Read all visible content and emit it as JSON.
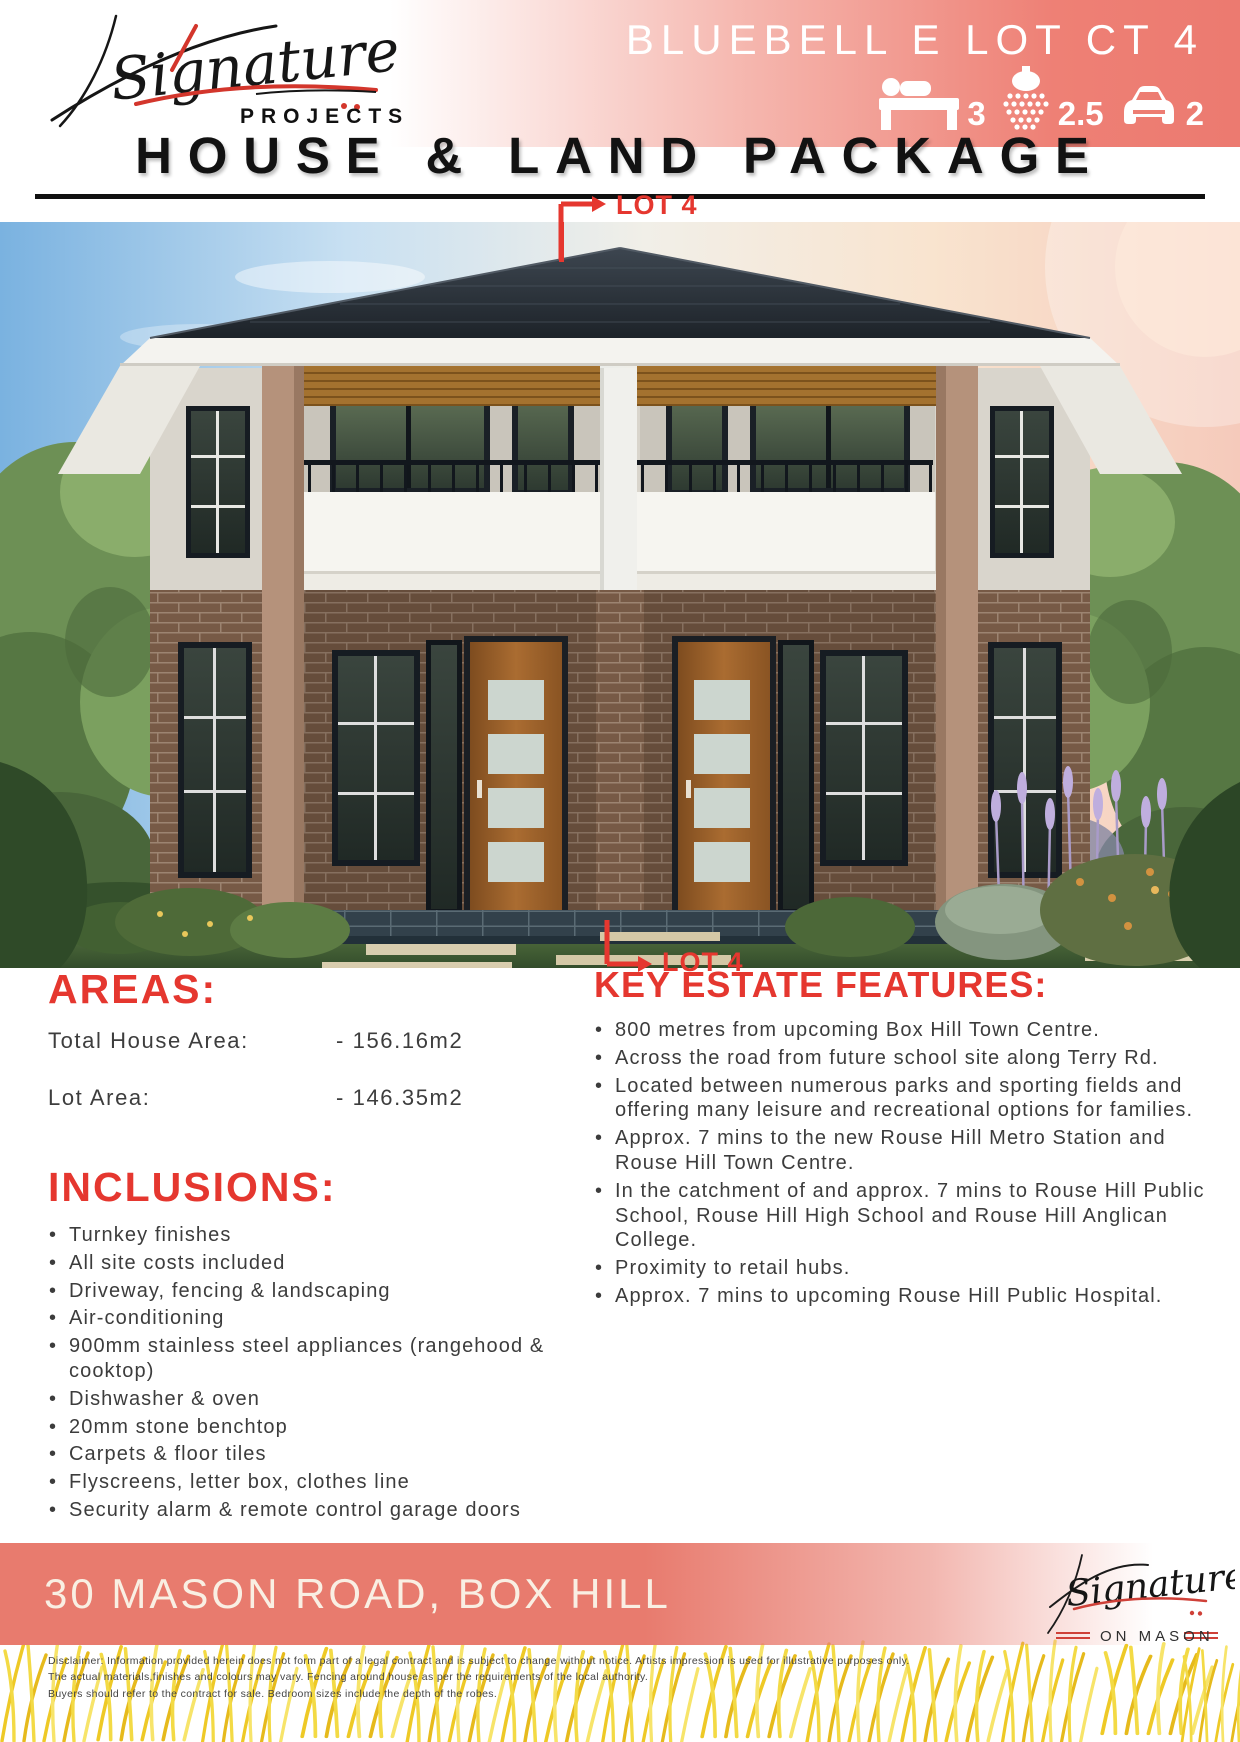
{
  "header": {
    "brand": {
      "name": "Signature",
      "sub": "PROJECTS"
    },
    "plan_title": "BLUEBELL E LOT CT 4",
    "stats": {
      "beds": "3",
      "baths": "2.5",
      "cars": "2"
    },
    "package_title": "HOUSE & LAND PACKAGE"
  },
  "lot_label_top": "LOT 4",
  "lot_label_bottom": "LOT 4",
  "areas": {
    "heading": "AREAS:",
    "rows": [
      {
        "label": "Total House Area:",
        "value": "- 156.16m2"
      },
      {
        "label": "Lot Area:",
        "value": "- 146.35m2"
      }
    ]
  },
  "key_features": {
    "heading": "KEY ESTATE FEATURES:",
    "items": [
      "800 metres from upcoming Box Hill Town Centre.",
      "Across the road from future school site along Terry Rd.",
      "Located between numerous parks and sporting fields and offering many leisure and recreational options for families.",
      "Approx. 7 mins to the new Rouse Hill Metro Station and Rouse Hill Town Centre.",
      "In the catchment of and approx. 7 mins to Rouse Hill Public School, Rouse Hill High School and Rouse Hill Anglican College.",
      "Proximity to retail hubs.",
      "Approx. 7 mins to upcoming Rouse Hill Public Hospital."
    ]
  },
  "inclusions": {
    "heading": "INCLUSIONS:",
    "items": [
      "Turnkey finishes",
      "All site costs included",
      "Driveway, fencing & landscaping",
      "Air-conditioning",
      "900mm stainless steel appliances (rangehood & cooktop)",
      "Dishwasher & oven",
      "20mm stone benchtop",
      "Carpets & floor tiles",
      "Flyscreens, letter box, clothes line",
      "Security alarm & remote control garage doors"
    ]
  },
  "footer": {
    "address": "30 MASON ROAD, BOX HILL",
    "brand": {
      "name": "Signature",
      "sub": "ON MASON"
    },
    "disclaimer": [
      "Disclaimer: Information provided herein does not form part of a legal contract and is subject to change without notice. Artists impression is used for illustrative purposes only.",
      "The actual materials,finishes and colours may vary. Fencing around house as per the requirements of the local authority.",
      "Buyers should refer to the contract for sale. Bedroom sizes include the depth of the robes."
    ]
  },
  "colors": {
    "accent_red": "#e5372f",
    "banner_coral": "#e87b6e",
    "header_pink": "#ee8075"
  }
}
